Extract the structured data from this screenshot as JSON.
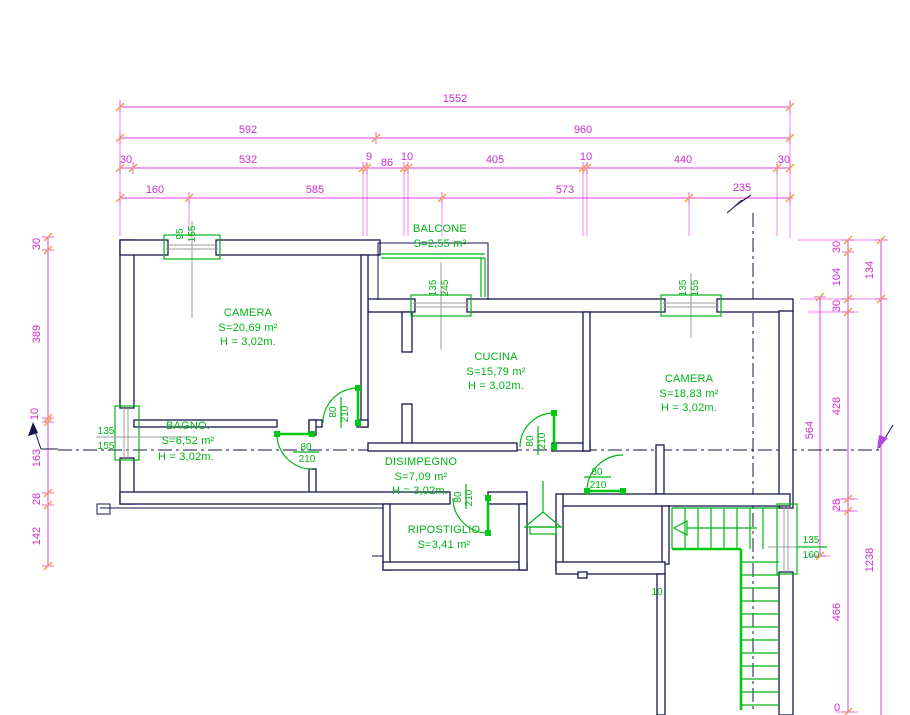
{
  "rooms": {
    "camera1": {
      "name": "CAMERA",
      "area": "S=20,69 m²",
      "height": "H = 3,02m."
    },
    "balcone": {
      "name": "BALCONE",
      "area": "S=2,55 m²"
    },
    "cucina": {
      "name": "CUCINA",
      "area": "S=15,79 m²",
      "height": "H = 3,02m."
    },
    "camera2": {
      "name": "CAMERA",
      "area": "S=18,83 m²",
      "height": "H = 3,02m."
    },
    "bagno": {
      "name": "BAGNO.",
      "area": "S=6,52 m²",
      "height": "H = 3,02m."
    },
    "disimpegno": {
      "name": "DISIMPEGNO",
      "area": "S=7,09 m²",
      "height": "H = 3,02m."
    },
    "ripostiglio": {
      "name": "RIPOSTIGLIO",
      "area": "S=3,41 m²"
    }
  },
  "dim_h": {
    "total": "1552",
    "left": "592",
    "right": "960",
    "row3": [
      "30",
      "532",
      "9",
      "86",
      "10",
      "405",
      "10",
      "440",
      "30"
    ],
    "row4": [
      "160",
      "585",
      "573",
      "235"
    ]
  },
  "dim_left": [
    "30",
    "389",
    "10",
    "163",
    "28",
    "142"
  ],
  "dim_right": {
    "chain1": "564",
    "chain2": [
      "30",
      "104",
      "30",
      "428",
      "28",
      "466",
      "0"
    ],
    "chain3": [
      "134",
      "1238"
    ]
  },
  "windows": {
    "w1": [
      "95",
      "155"
    ],
    "w2": [
      "135",
      "245"
    ],
    "w3": [
      "135",
      "155"
    ],
    "w4": [
      "135",
      "155"
    ],
    "w5": [
      "135",
      "160"
    ]
  },
  "doors": {
    "w": "80",
    "h": "210"
  },
  "misc": {
    "stair_gap": "10"
  },
  "colors": {
    "dim": "#cc2fcc",
    "tick": "#f0a43c",
    "wall": "#16164e",
    "green": "#00b414",
    "gray": "#9c9c9c"
  }
}
